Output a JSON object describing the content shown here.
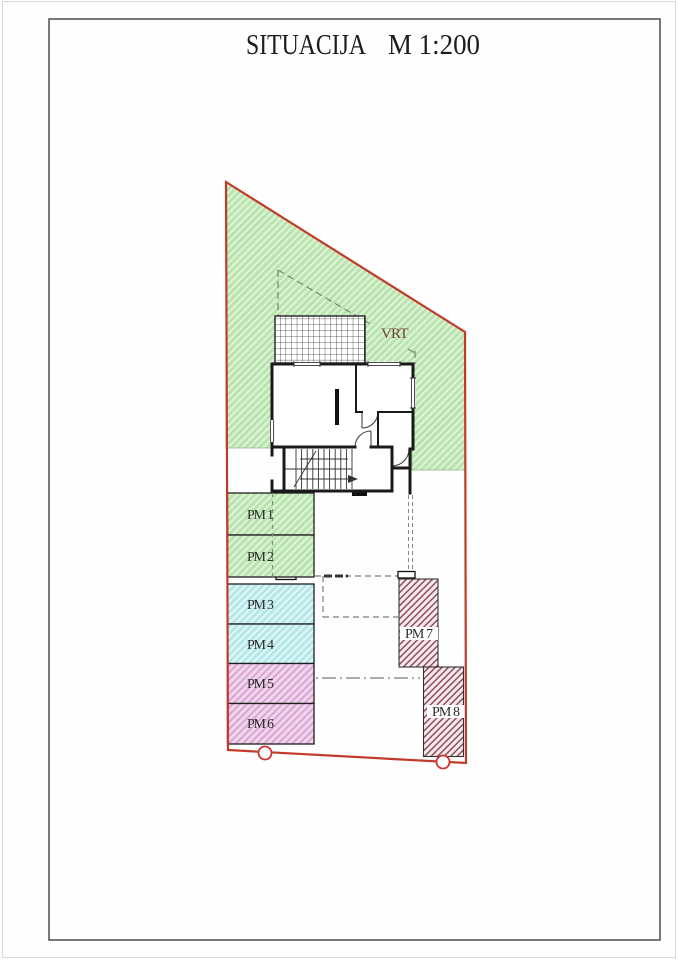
{
  "page": {
    "title_main": "SITUACIJA",
    "title_scale": "M 1:200"
  },
  "site_plan": {
    "garden_label": "VRT",
    "parking_stalls": [
      {
        "label": "PM 1",
        "type": "green"
      },
      {
        "label": "PM 2",
        "type": "green"
      },
      {
        "label": "PM 3",
        "type": "cyan"
      },
      {
        "label": "PM 4",
        "type": "cyan"
      },
      {
        "label": "PM 5",
        "type": "pink"
      },
      {
        "label": "PM 6",
        "type": "pink"
      },
      {
        "label": "PM 7",
        "type": "maroon"
      },
      {
        "label": "PM 8",
        "type": "maroon"
      }
    ]
  },
  "colors": {
    "title_text": "#1c1c1c",
    "label_text": "#2a2a2a",
    "garden_text": "#6e4434",
    "boundary_red": "#c23b2a",
    "marker_red": "#cc3333",
    "wall": "#1a1a1a",
    "green_bg": "#b9e4ae",
    "green_stripe": "#dff3da",
    "cyan_bg": "#b6e8ea",
    "cyan_stripe": "#e2f7f8",
    "pink_bg": "#f0d6ec",
    "pink_stripe": "#d9a0d0",
    "maroon_bg": "#f6ecee",
    "maroon_stripe": "#8c4050",
    "frame_gray": "#4d4d4d"
  }
}
